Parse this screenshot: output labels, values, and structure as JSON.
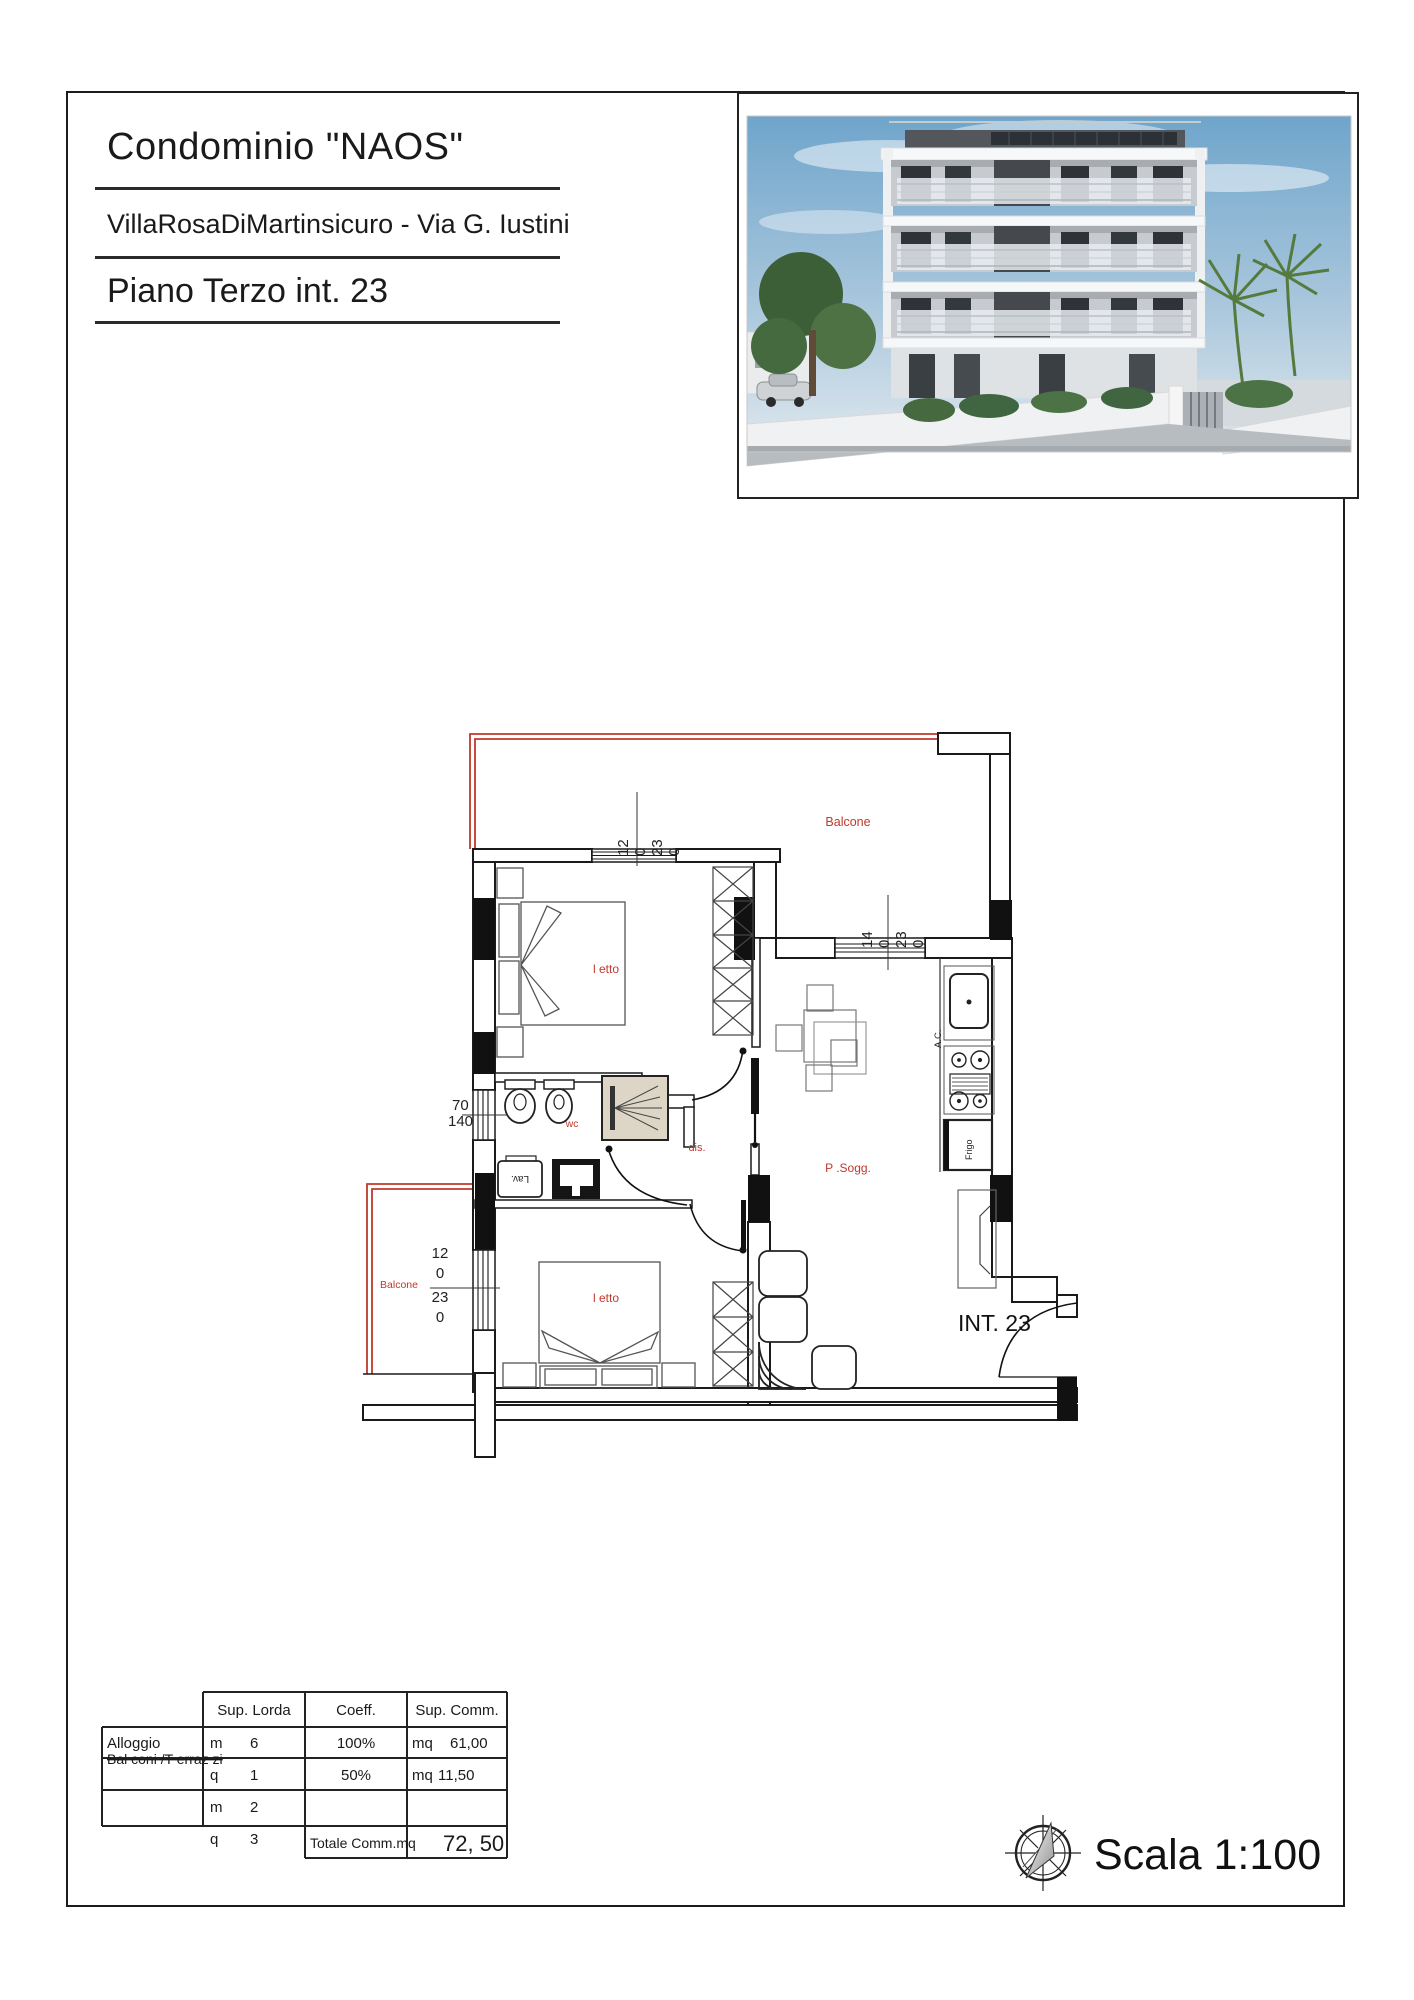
{
  "theme": {
    "accent_red": "#c0392b",
    "line_black": "#1a1a1a"
  },
  "header": {
    "title": "Condominio \"NAOS\"",
    "subtitle": "VillaRosaDiMartinsicuro - Via G. Iustini",
    "floor_label": "Piano Terzo int. 23"
  },
  "floor_plan": {
    "unit_label": "INT. 23",
    "rooms": {
      "bedroom_top": "l etto",
      "bedroom_bottom": "l etto",
      "bathroom": "wc",
      "hallway": "dis.",
      "living": "P .Sogg.",
      "balcony_top": "Balcone",
      "balcony_left": "Balcone"
    },
    "appliances": {
      "sink": "A.C.",
      "fridge": "Frigo",
      "washer": "Lav."
    },
    "dimensions": {
      "window_top": [
        "12",
        "0",
        "23",
        "0"
      ],
      "window_kitchen": [
        "14",
        "0",
        "23",
        "0"
      ],
      "window_bath": [
        "70",
        "140"
      ],
      "window_bedroom2": [
        "12",
        "0",
        "23",
        "0"
      ]
    }
  },
  "summary_table": {
    "headers": [
      "Sup. Lorda",
      "Coeff.",
      "Sup. Comm."
    ],
    "rows": [
      {
        "label": "Alloggio",
        "lorda": [
          "m",
          "6"
        ],
        "coeff": "100%",
        "comm_unit": "mq",
        "comm_value": "61,00"
      },
      {
        "label": "Bal coni /T erraz zi",
        "lorda": [
          "q",
          "1"
        ],
        "coeff": "50%",
        "comm_unit": "mq",
        "comm_value": "11,50"
      },
      {
        "lorda": [
          "m",
          "2"
        ]
      },
      {
        "lorda": [
          "q",
          "3"
        ],
        "total_label": "Totale Comm.mq",
        "total_value": "72, 50"
      }
    ]
  },
  "footer": {
    "scale_label": "Scala 1:100"
  }
}
